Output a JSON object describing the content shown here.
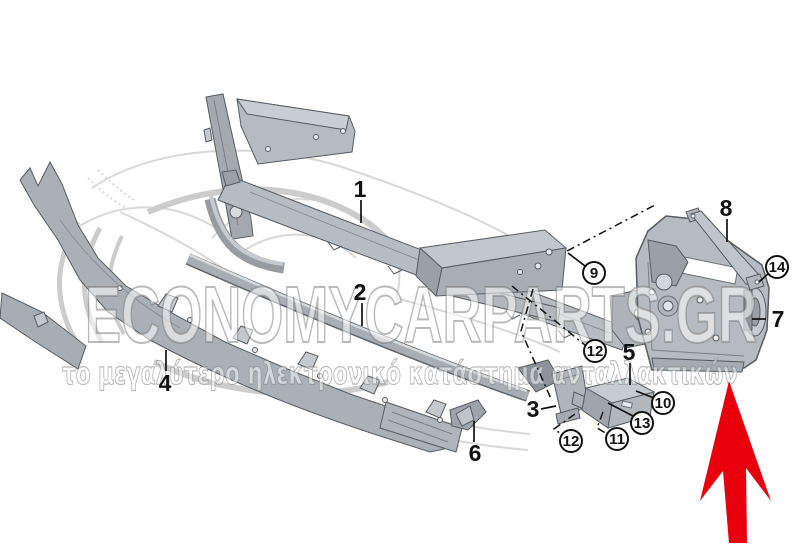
{
  "watermark": {
    "brand": "ECONOMYCARPARTS.GR",
    "tagline": "το μεγαλύτερο ηλεκτρονικό κατάστημα ανταλλακτικών"
  },
  "labels": {
    "n1": "1",
    "n2": "2",
    "n3": "3",
    "n4": "4",
    "n5": "5",
    "n6": "6",
    "n7": "7",
    "n8": "8"
  },
  "callouts": {
    "c9": "9",
    "c10": "10",
    "c11": "11",
    "c12a": "12",
    "c12b": "12",
    "c13": "13",
    "c14": "14"
  },
  "highlight": {
    "arrow_color": "#e8000d",
    "points_to_label": "7"
  },
  "palette": {
    "part_fill_light": "#c9ced4",
    "part_fill_mid": "#b2b7bd",
    "part_fill_dark": "#9aa0a6",
    "part_stroke": "#565c62",
    "label_color": "#111111"
  }
}
